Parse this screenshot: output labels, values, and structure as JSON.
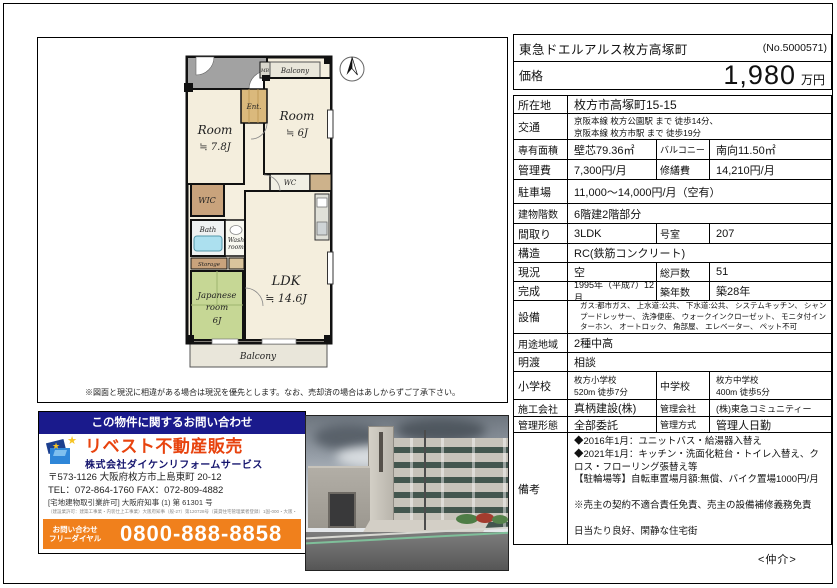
{
  "header": {
    "title": "東急ドエルアルス枚方高塚町",
    "listing_no": "(No.5000571)",
    "price_label": "価格",
    "price_value": "1,980",
    "price_unit": "万円"
  },
  "property_table": {
    "rows": [
      {
        "label": "所在地",
        "value": "枚方市高塚町15-15"
      },
      {
        "label": "交通",
        "line1": "京阪本線 枚方公園駅 まで 徒歩14分、",
        "line2": "京阪本線 枚方市駅 まで 徒歩19分"
      },
      {
        "label": "専有面積",
        "value": "壁芯79.36㎡",
        "label2": "バルコニー",
        "value2": "南向11.50㎡"
      },
      {
        "label": "管理費",
        "value": "7,300円/月",
        "label2": "修繕費",
        "value2": "14,210円/月"
      },
      {
        "label": "駐車場",
        "value": "11,000～14,000円/月（空有）"
      },
      {
        "label": "建物階数",
        "value": "6階建2階部分"
      },
      {
        "label": "間取り",
        "value": "3LDK",
        "label2": "号室",
        "value2": "207"
      },
      {
        "label": "構造",
        "value": "RC(鉄筋コンクリート)"
      },
      {
        "label": "現況",
        "value": "空",
        "label2": "総戸数",
        "value2": "51"
      },
      {
        "label": "完成",
        "value": "1995年（平成7）12月",
        "label2": "築年数",
        "value2": "築28年"
      },
      {
        "label": "設備",
        "value": "ガス:都市ガス、 上水道:公共、 下水道:公共、 システムキッチン、 シャンプードレッサー、 洗浄便座、 ウォークインクローゼット、 モニタ付インターホン、 オートロック、 角部屋、 エレベーター、 ペット不可"
      },
      {
        "label": "用途地域",
        "value": "2種中高"
      },
      {
        "label": "明渡",
        "value": "相談"
      },
      {
        "label": "小学校",
        "value_line1": "枚方小学校",
        "value_line2": "520m 徒歩7分",
        "label2": "中学校",
        "value2_line1": "枚方中学校",
        "value2_line2": "400m 徒歩5分"
      },
      {
        "label": "施工会社",
        "value": "真柄建設(株)",
        "label2": "管理会社",
        "value2": "(株)東急コミュニティー"
      },
      {
        "label": "管理形態",
        "value": "全部委託",
        "label2": "管理方式",
        "value2": "管理人日勤"
      },
      {
        "label": "備考",
        "lines": [
          "◆2016年1月：ユニットバス・給湯器入替え",
          "◆2021年1月：キッチン・洗面化粧台・トイレ入替え、クロス・フローリング張替え等",
          "【駐輪場等】自転車置場月額:無償、バイク置場1000円/月",
          "",
          "※売主の契約不適合責任免責、売主の設備補修義務免責",
          "",
          "日当たり良好、閑静な住宅街"
        ]
      }
    ]
  },
  "floorplan": {
    "caption": "※図面と現況に相違がある場合は現況を優先とします。なお、売却済の場合はあしからずご了承下さい。",
    "labels": {
      "room1": "Room",
      "room1_size": "≒ 7.8J",
      "room2": "Room",
      "room2_size": "≒ 6J",
      "ldk": "LDK",
      "ldk_size": "≒ 14.6J",
      "japanese_1": "Japanese",
      "japanese_2": "room",
      "japanese_3": "6J",
      "wic": "WIC",
      "ent": "Ent.",
      "bath": "Bath",
      "wash_1": "Wash",
      "wash_2": "room",
      "wc": "WC",
      "storage": "Storage",
      "mb": "MB",
      "balcony_top": "Balcony",
      "balcony_bottom": "Balcony"
    }
  },
  "agency": {
    "inquiry_header": "この物件に関するお問い合わせ",
    "brand": "リベスト不動産販売",
    "company": "株式会社ダイケンリフォームサービス",
    "address": "〒573-1126 大阪府枚方市上島東町 20-12",
    "tel_fax": "TEL：072-864-1760  FAX：072-809-4882",
    "license": "[宅地建物取引業許可] 大阪府知事 (1) 第 61301 号",
    "license_small": "（建設業許可：建築工事業・内装仕上工事業）大阪府知事（般-27）第120728号（賃貸住宅管理業者登録）1国-000・大阪・京都・兵庫 ほか",
    "phone_label_1": "お問い合わせ",
    "phone_label_2": "フリーダイヤル",
    "phone_number": "0800-888-8858",
    "star_glyph": "★"
  },
  "footer": {
    "broker_label": "<仲介>"
  },
  "colors": {
    "header_navy": "#1a1a8c",
    "brand_orange_red": "#e8430e",
    "phone_bar_orange": "#f0801c",
    "tatami_green": "#c6d795",
    "floor_beige": "#f4eedd"
  }
}
